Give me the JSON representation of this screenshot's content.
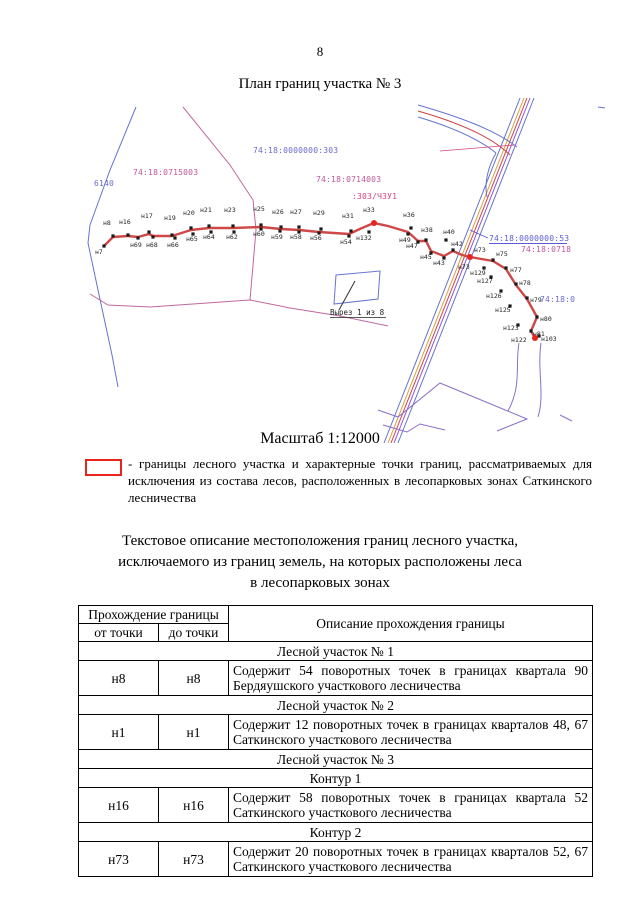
{
  "page": {
    "number": "8",
    "title": "План границ участка № 3"
  },
  "map": {
    "scale_caption": "Масштаб 1:12000",
    "cutout_label": "Вырез 1 из 8",
    "cadastral_labels": [
      {
        "text": "74:18:0715003",
        "x": 133,
        "y": 80,
        "color": "#c0569a"
      },
      {
        "text": "74:18:0000000:303",
        "x": 253,
        "y": 58,
        "color": "#6a6ad0"
      },
      {
        "text": "74:18:0714003",
        "x": 316,
        "y": 87,
        "color": "#c0569a"
      },
      {
        "text": ":303/ЧЗУ1",
        "x": 352,
        "y": 104,
        "color": "#d4457e"
      },
      {
        "text": "6140",
        "x": 94,
        "y": 91,
        "color": "#6a6ad0"
      },
      {
        "text": "74:18:0000000:53",
        "x": 489,
        "y": 146,
        "color": "#5b5bd6",
        "underline": true
      },
      {
        "text": "74:18:0718",
        "x": 521,
        "y": 157,
        "color": "#c0569a"
      },
      {
        "text": "74:18:0",
        "x": 540,
        "y": 207,
        "color": "#6a6ad0"
      }
    ],
    "points": [
      {
        "label": "н7",
        "x": 104,
        "y": 151,
        "lx": 95,
        "ly": 159
      },
      {
        "label": "н8",
        "x": 113,
        "y": 141,
        "lx": 103,
        "ly": 130
      },
      {
        "label": "н16",
        "x": 128,
        "y": 140,
        "lx": 119,
        "ly": 129
      },
      {
        "label": "н69",
        "x": 138,
        "y": 143,
        "lx": 130,
        "ly": 152
      },
      {
        "label": "н17",
        "x": 149,
        "y": 137,
        "lx": 141,
        "ly": 123
      },
      {
        "label": "н68",
        "x": 153,
        "y": 142,
        "lx": 146,
        "ly": 152
      },
      {
        "label": "н19",
        "x": 172,
        "y": 140,
        "lx": 164,
        "ly": 125
      },
      {
        "label": "н66",
        "x": 175,
        "y": 143,
        "lx": 167,
        "ly": 152
      },
      {
        "label": "н20",
        "x": 191,
        "y": 133,
        "lx": 183,
        "ly": 120
      },
      {
        "label": "н65",
        "x": 193,
        "y": 139,
        "lx": 186,
        "ly": 146
      },
      {
        "label": "н21",
        "x": 209,
        "y": 131,
        "lx": 200,
        "ly": 117
      },
      {
        "label": "н64",
        "x": 211,
        "y": 137,
        "lx": 203,
        "ly": 144
      },
      {
        "label": "н23",
        "x": 233,
        "y": 131,
        "lx": 224,
        "ly": 117
      },
      {
        "label": "н62",
        "x": 234,
        "y": 137,
        "lx": 226,
        "ly": 144
      },
      {
        "label": "н25",
        "x": 261,
        "y": 130,
        "lx": 253,
        "ly": 116
      },
      {
        "label": "н60",
        "x": 261,
        "y": 134,
        "lx": 253,
        "ly": 141
      },
      {
        "label": "н26",
        "x": 281,
        "y": 132,
        "lx": 272,
        "ly": 119
      },
      {
        "label": "н59",
        "x": 280,
        "y": 136,
        "lx": 271,
        "ly": 144
      },
      {
        "label": "н27",
        "x": 299,
        "y": 132,
        "lx": 290,
        "ly": 119
      },
      {
        "label": "н58",
        "x": 299,
        "y": 137,
        "lx": 290,
        "ly": 144
      },
      {
        "label": "н29",
        "x": 321,
        "y": 134,
        "lx": 313,
        "ly": 120
      },
      {
        "label": "н56",
        "x": 319,
        "y": 138,
        "lx": 310,
        "ly": 145
      },
      {
        "label": "н31",
        "x": 351,
        "y": 136,
        "lx": 342,
        "ly": 123
      },
      {
        "label": "н54",
        "x": 349,
        "y": 141,
        "lx": 340,
        "ly": 149
      },
      {
        "label": "н33",
        "x": 374,
        "y": 128,
        "lx": 363,
        "ly": 117,
        "red": true
      },
      {
        "label": "н132",
        "x": 369,
        "y": 137,
        "lx": 356,
        "ly": 145
      },
      {
        "label": "н36",
        "x": 411,
        "y": 133,
        "lx": 403,
        "ly": 122
      },
      {
        "label": "н49",
        "x": 408,
        "y": 139,
        "lx": 399,
        "ly": 147
      },
      {
        "label": "н38",
        "x": 426,
        "y": 145,
        "lx": 421,
        "ly": 137
      },
      {
        "label": "н47",
        "x": 418,
        "y": 147,
        "lx": 406,
        "ly": 153
      },
      {
        "label": "н40",
        "x": 446,
        "y": 145,
        "lx": 443,
        "ly": 139
      },
      {
        "label": "н45",
        "x": 431,
        "y": 158,
        "lx": 420,
        "ly": 164
      },
      {
        "label": "н42",
        "x": 453,
        "y": 155,
        "lx": 451,
        "ly": 151
      },
      {
        "label": "н43",
        "x": 444,
        "y": 163,
        "lx": 433,
        "ly": 170
      },
      {
        "label": "н73",
        "x": 470,
        "y": 162,
        "lx": 474,
        "ly": 157,
        "red": true
      },
      {
        "label": "н73",
        "x": 461,
        "y": 172,
        "lx": 458,
        "ly": 174,
        "labelOnly": true
      },
      {
        "label": "н75",
        "x": 493,
        "y": 165,
        "lx": 496,
        "ly": 161
      },
      {
        "label": "н129",
        "x": 484,
        "y": 173,
        "lx": 470,
        "ly": 180
      },
      {
        "label": "н77",
        "x": 506,
        "y": 173,
        "lx": 510,
        "ly": 177
      },
      {
        "label": "н127",
        "x": 491,
        "y": 182,
        "lx": 477,
        "ly": 188
      },
      {
        "label": "н78",
        "x": 516,
        "y": 189,
        "lx": 519,
        "ly": 190
      },
      {
        "label": "н126",
        "x": 501,
        "y": 196,
        "lx": 486,
        "ly": 203
      },
      {
        "label": "н79",
        "x": 527,
        "y": 203,
        "lx": 530,
        "ly": 207
      },
      {
        "label": "н125",
        "x": 510,
        "y": 211,
        "lx": 495,
        "ly": 217
      },
      {
        "label": "н80",
        "x": 537,
        "y": 222,
        "lx": 540,
        "ly": 226
      },
      {
        "label": "н123",
        "x": 518,
        "y": 230,
        "lx": 503,
        "ly": 235
      },
      {
        "label": "н81",
        "x": 531,
        "y": 236,
        "lx": 533,
        "ly": 241
      },
      {
        "label": "н103",
        "x": 539,
        "y": 241,
        "lx": 541,
        "ly": 246
      },
      {
        "label": "н122",
        "x": 535,
        "y": 243,
        "lx": 511,
        "ly": 247,
        "red": true
      }
    ]
  },
  "legend": {
    "description": "- границы лесного участка и характерные точки границ, рассматриваемых для исключения из состава лесов, расположенных в лесопарковых зонах Саткинского лесничества"
  },
  "section": {
    "heading_line1": "Текстовое описание местоположения границ лесного участка,",
    "heading_line2": "исключаемого из границ земель, на которых расположены леса",
    "heading_line3": "в лесопарковых зонах"
  },
  "table": {
    "headers": {
      "passage": "Прохождение границы",
      "from": "от точки",
      "to": "до точки",
      "description": "Описание прохождения границы"
    },
    "rows": [
      {
        "type": "section",
        "text": "Лесной участок № 1"
      },
      {
        "type": "data",
        "from": "н8",
        "to": "н8",
        "desc": "Содержит 54 поворотных точек в границах квартала 90 Бердяушского участкового лесничества"
      },
      {
        "type": "section",
        "text": "Лесной участок № 2"
      },
      {
        "type": "data",
        "from": "н1",
        "to": "н1",
        "desc": "Содержит 12 поворотных точек в границах кварталов 48, 67 Саткинского участкового лесничества"
      },
      {
        "type": "section",
        "text": "Лесной участок № 3"
      },
      {
        "type": "section",
        "text": "Контур 1"
      },
      {
        "type": "data",
        "from": "н16",
        "to": "н16",
        "desc": "Содержит 58 поворотных точек в границах квартала 52 Саткинского участкового лесничества"
      },
      {
        "type": "section",
        "text": "Контур 2"
      },
      {
        "type": "data",
        "from": "н73",
        "to": "н73",
        "desc": "Содержит 20 поворотных точек в границах кварталов 52, 67 Саткинского участкового лесничества"
      }
    ]
  },
  "colors": {
    "legend_red": "#e8241d",
    "boundary_red": "#cf4747",
    "marker_black": "#1a1a1a",
    "marker_red": "#e8241d",
    "road_blue": "#6673cf",
    "quarter_pink": "#c0679d",
    "road_purple": "#9255cc",
    "road_orange": "#d8a13f"
  }
}
